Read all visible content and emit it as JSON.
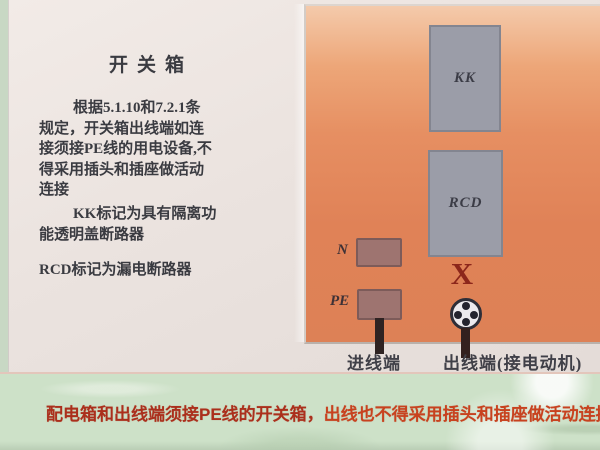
{
  "slide": {
    "title": "开关箱",
    "left_text": {
      "p1": {
        "l1": "根据5.1.10和7.2.1条",
        "l2": "规定，开关箱出线端如连",
        "l3": "接须接PE线的用电设备,不",
        "l4": "得采用插头和插座做活动",
        "l5": "连接"
      },
      "p2": {
        "l1": "KK标记为具有隔离功",
        "l2": "能透明盖断路器"
      },
      "p3": {
        "l1": "RCD标记为漏电断路器"
      }
    },
    "diagram": {
      "kk_label": "KK",
      "rcd_label": "RCD",
      "n_label": "N",
      "pe_label": "PE",
      "x_mark": "X",
      "incoming_label": "进线端",
      "outgoing_label": "出线端(接电动机)"
    },
    "banner": {
      "segment1": "配电箱和出线端须接PE线的开关箱，",
      "segment2": "出线也不得采用插头和插座做活动连接。"
    }
  },
  "colors": {
    "ink": "#3a3b41",
    "panel_orange": "#e38a5e",
    "breaker_gray": "#9b9da8",
    "terminal_brown": "#9e7470",
    "prohibit_red": "#8c271b",
    "band_green": "#cde1c8",
    "banner_dark_red": "#ab2f1c",
    "banner_red": "#c8421f"
  }
}
